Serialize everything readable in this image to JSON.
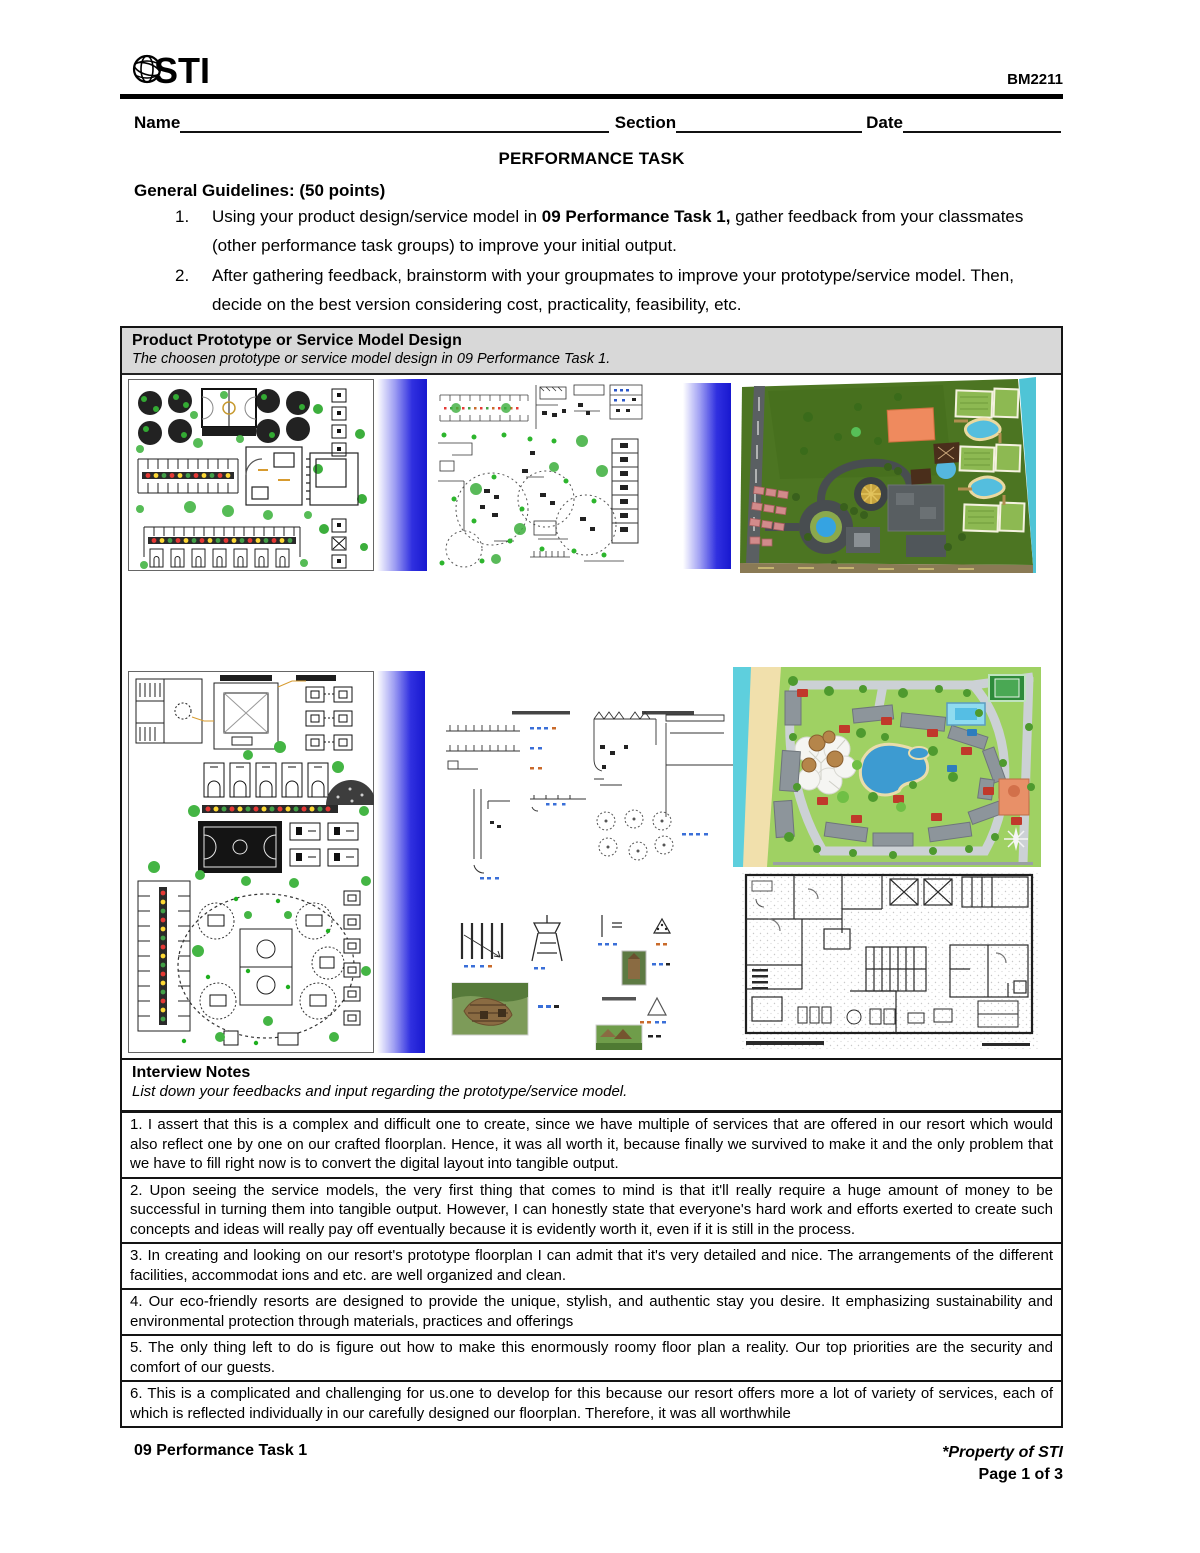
{
  "header": {
    "logo_text": "STI",
    "logo_icon": "globe-icon",
    "course_code": "BM2211"
  },
  "fields": {
    "name_label": "Name",
    "section_label": "Section",
    "date_label": "Date"
  },
  "doc_title": "PERFORMANCE TASK",
  "guidelines": {
    "heading": "General Guidelines: (50 points)",
    "items": [
      {
        "number": "1.",
        "pre": "Using your product design/service model in ",
        "bold": "09 Performance Task 1,",
        "post": " gather feedback from your classmates (other performance task groups) to improve your initial output."
      },
      {
        "number": "2.",
        "pre": "After gathering feedback, brainstorm with your groupmates to improve your prototype/service model. Then, decide on the best version considering cost, practicality, feasibility, etc.",
        "bold": "",
        "post": ""
      }
    ]
  },
  "prototype_box": {
    "title": "Product Prototype or Service Model Design",
    "subtitle": "The choosen prototype or service model design in 09 Performance Task 1.",
    "images": [
      "site-development-plan-1",
      "site-development-plan-2",
      "resort-master-plan-render",
      "site-development-plan-3",
      "elevation-details-sheet",
      "resort-map-illustration",
      "ground-floor-plan"
    ]
  },
  "interview": {
    "title": "Interview Notes",
    "subtitle": "List down your feedbacks and input regarding the prototype/service model.",
    "notes": [
      "1. I assert that this is a complex and difficult one to create, since we have multiple of services that are offered in our resort which would also reflect one by one on our crafted floorplan. Hence, it was all worth it, because finally we survived to make it and the only problem that we have to fill right now is to convert the digital layout into tangible output.",
      "2. Upon seeing the service models, the very first thing that comes to mind is that it'll really require a huge amount of money to be successful in turning them into tangible output. However, I can honestly state that everyone's hard work and efforts exerted to create such concepts and ideas will really pay off eventually because it is evidently worth it, even if it is still in the process.",
      "3. In creating and looking on our resort's prototype floorplan I can admit that it's very detailed and nice. The arrangements of the different facilities, accommodat ions and etc. are well organized and clean.",
      "4. Our eco-friendly resorts are designed to provide the unique, stylish, and authentic stay you desire. It emphasizing sustainability and environmental protection through materials, practices and offerings",
      "5. The only thing left to do is figure out how to make this enormously roomy floor plan a reality. Our top priorities are the security and comfort of our guests.",
      "6. This is a complicated and challenging for us.one to develop for this because our resort offers more a lot of variety of services, each of which is reflected individually in our carefully designed our floorplan. Therefore, it was all worthwhile"
    ]
  },
  "footer": {
    "left": "09 Performance Task 1",
    "right_line1": "*Property of STI",
    "right_line2": "Page 1 of 3"
  },
  "colors": {
    "gradient_blue": "#1818cf",
    "box_header_bg": "#d8d8d8",
    "tree_green": "#3cae3c",
    "water_teal": "#4fc4d6",
    "lawn_green": "#4c7522",
    "resort_grass": "#9fd163",
    "badge_red": "#c0392b"
  }
}
